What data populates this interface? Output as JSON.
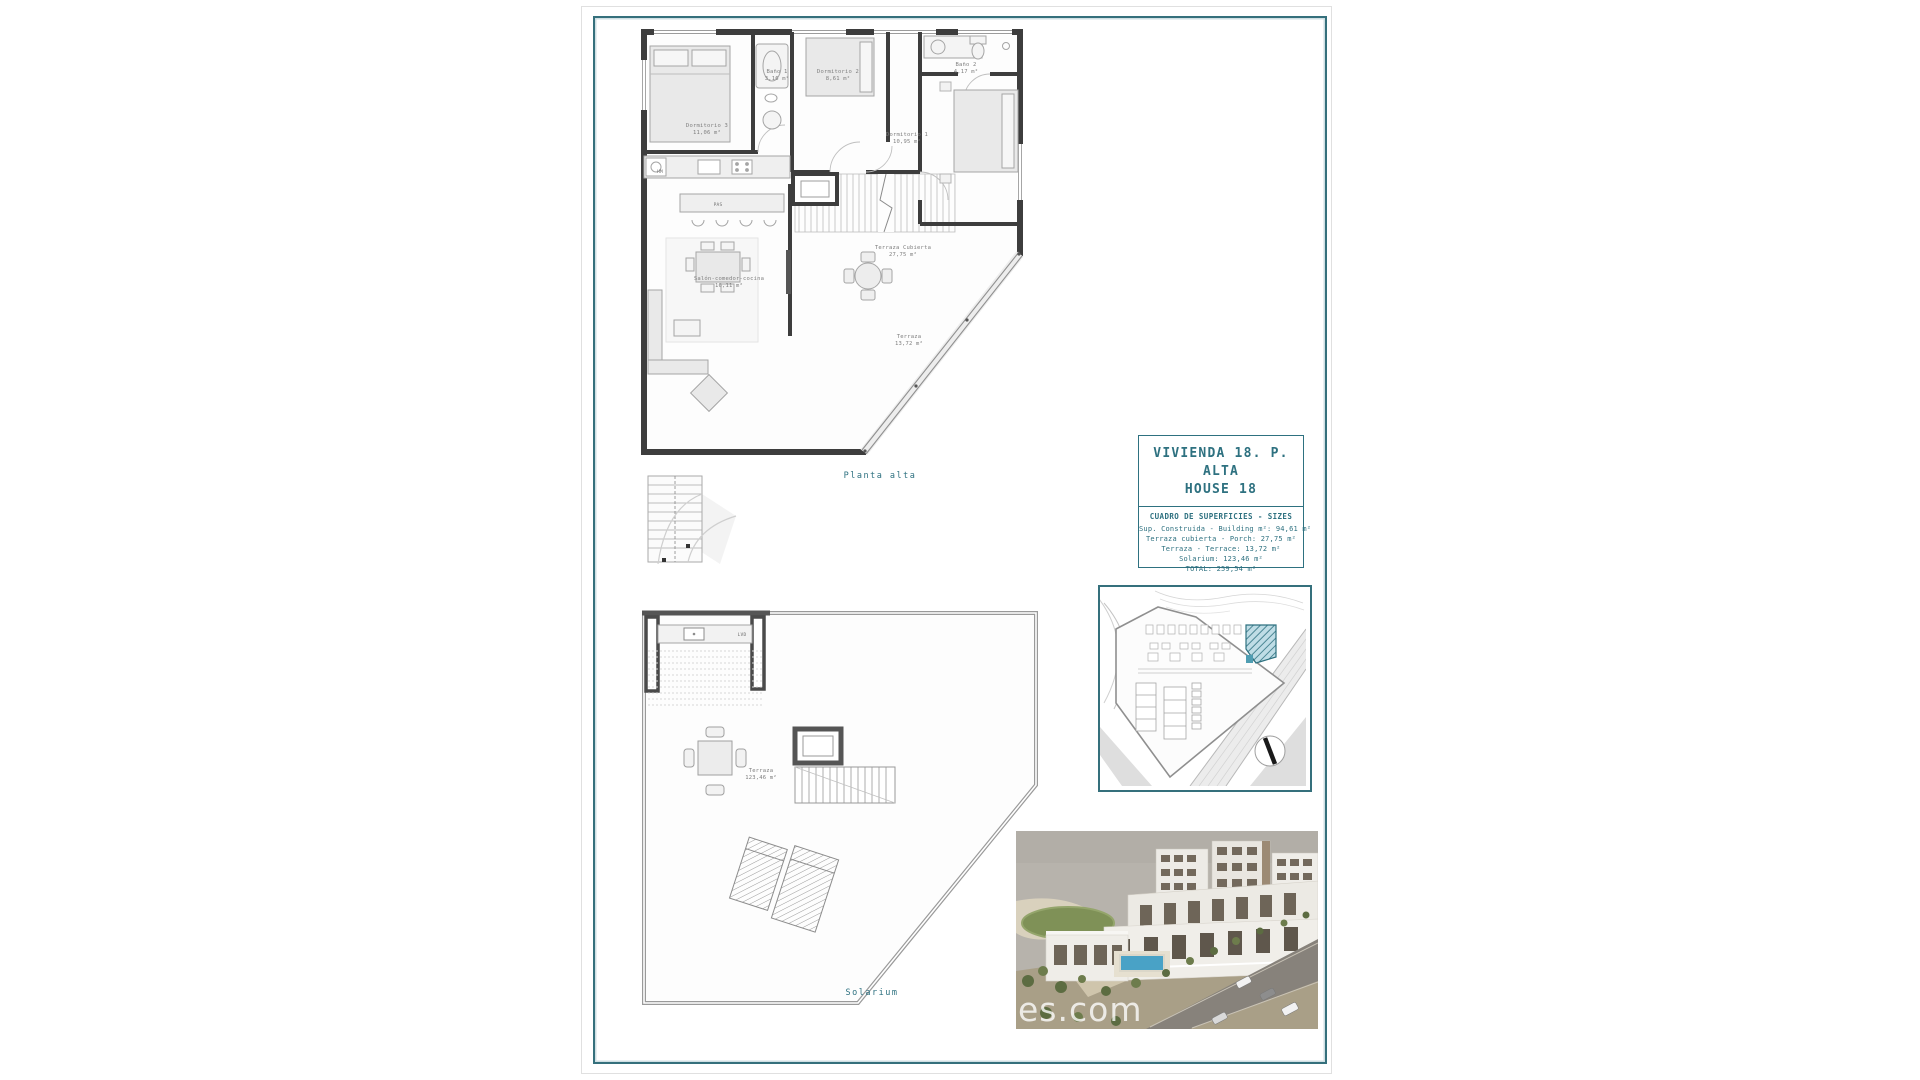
{
  "page": {
    "plan_top_caption": "Planta alta",
    "plan_bottom_caption": "Solarium",
    "watermark": "es.com"
  },
  "title_block": {
    "title_line1": "VIVIENDA 18. P. ALTA",
    "title_line2": "HOUSE 18",
    "table_title": "CUADRO DE SUPERFICIES  - SIZES",
    "rows": [
      "Sup. Construida  - Building m²: 94,61 m²",
      "Terraza cubierta  - Porch: 27,75 m²",
      "Terraza - Terrace: 13,72 m²",
      "Solarium:  123,46 m²",
      "TOTAL:  259,54 m²"
    ]
  },
  "upper_plan": {
    "rooms": [
      {
        "name": "Dormitorio 3",
        "area": "11,06 m²"
      },
      {
        "name": "Baño 1",
        "area": "3,16 m²"
      },
      {
        "name": "Dormitorio 2",
        "area": "8,61 m²"
      },
      {
        "name": "Baño 2",
        "area": "4,17 m²"
      },
      {
        "name": "Dormitorio 1",
        "area": "10,95 m²"
      },
      {
        "name": "Salón-comedor-cocina",
        "area": "16,11 m²"
      },
      {
        "name": "Terraza Cubierta",
        "area": "27,75 m²"
      },
      {
        "name": "Terraza",
        "area": "13,72 m²"
      }
    ],
    "small_labels": {
      "washer": "HM",
      "pantry": "PAS"
    }
  },
  "lower_plan": {
    "rooms": [
      {
        "name": "Terraza",
        "area": "123,46 m²"
      }
    ],
    "small_labels": {
      "laundry": "LVD"
    }
  }
}
